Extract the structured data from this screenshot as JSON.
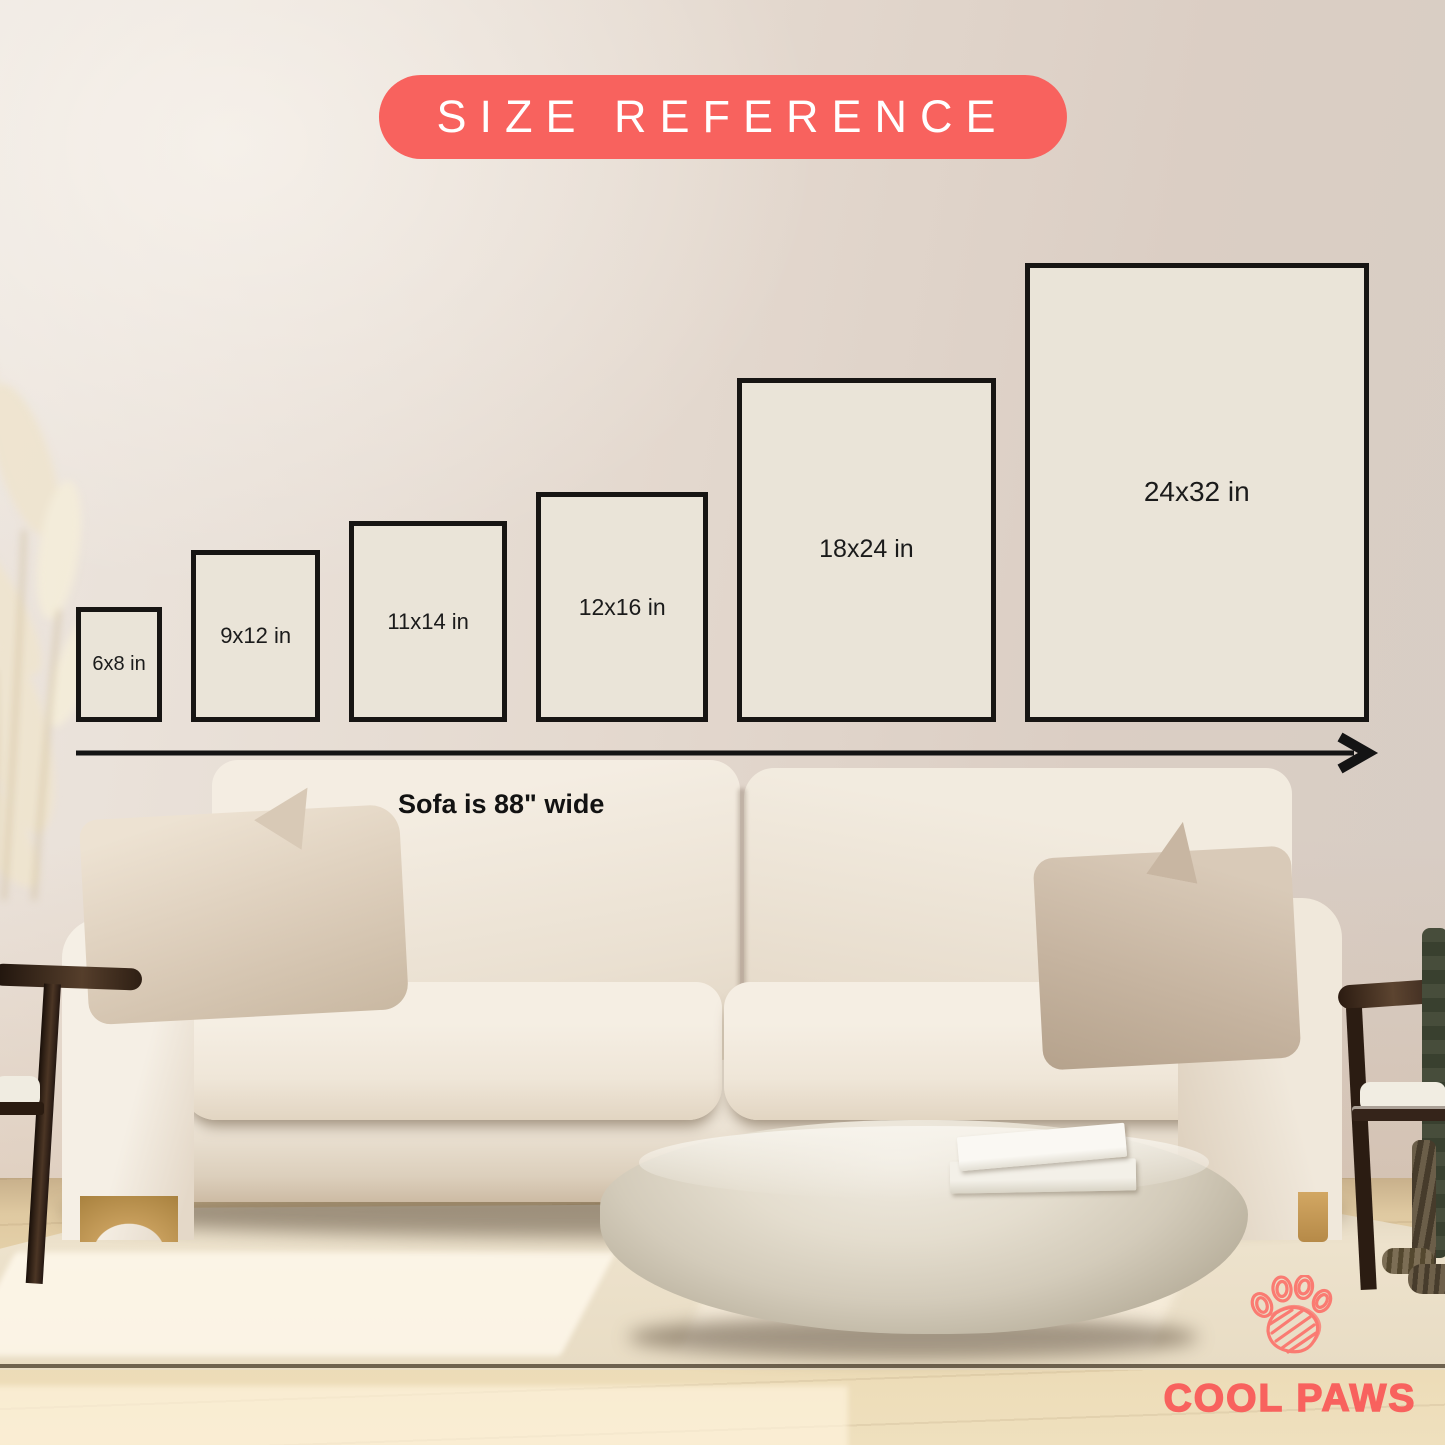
{
  "title_badge": {
    "label": "SIZE REFERENCE",
    "bg": "#F8625E",
    "fg": "#FFFFFF"
  },
  "size_chart": {
    "unit": "in",
    "scale_px_per_in": 14.35,
    "sizes": [
      {
        "label": "6x8 in",
        "w": 6,
        "h": 8
      },
      {
        "label": "9x12 in",
        "w": 9,
        "h": 12
      },
      {
        "label": "11x14 in",
        "w": 11,
        "h": 14
      },
      {
        "label": "12x16 in",
        "w": 12,
        "h": 16
      },
      {
        "label": "18x24 in",
        "w": 18,
        "h": 24
      },
      {
        "label": "24x32 in",
        "w": 24,
        "h": 32
      }
    ],
    "box_fill": "#EAE4D8",
    "box_border": "#171513",
    "label_color": "#1B1B1B",
    "arrow_color": "#141414",
    "sofa_note": "Sofa is 88\" wide"
  },
  "brand": {
    "name": "COOL PAWS",
    "color": "#F9655F",
    "icon": "paw-print-icon"
  }
}
